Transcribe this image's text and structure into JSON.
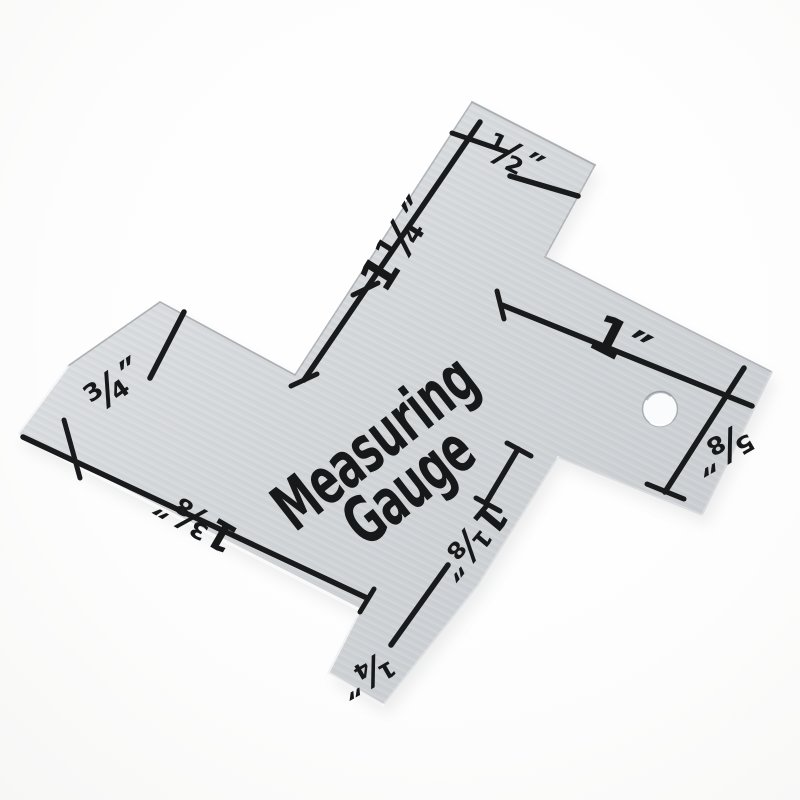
{
  "product": {
    "title_line1": "Measuring",
    "title_line2": "Gauge",
    "labels": {
      "half": "½″",
      "one_quarter": "1¼″",
      "one": "1″",
      "five_eighths": "⅝″",
      "three_quarters": "¾″",
      "one_three_eighths": "1⅜″",
      "one_one_eighth": "1⅛″",
      "quarter": "¼″"
    },
    "colors": {
      "plate_light": "#e0e2e4",
      "plate_mid": "#d2d5d8",
      "plate_dark": "#c7cacd",
      "ink": "#17181a",
      "background": "#fdfdfd"
    }
  }
}
